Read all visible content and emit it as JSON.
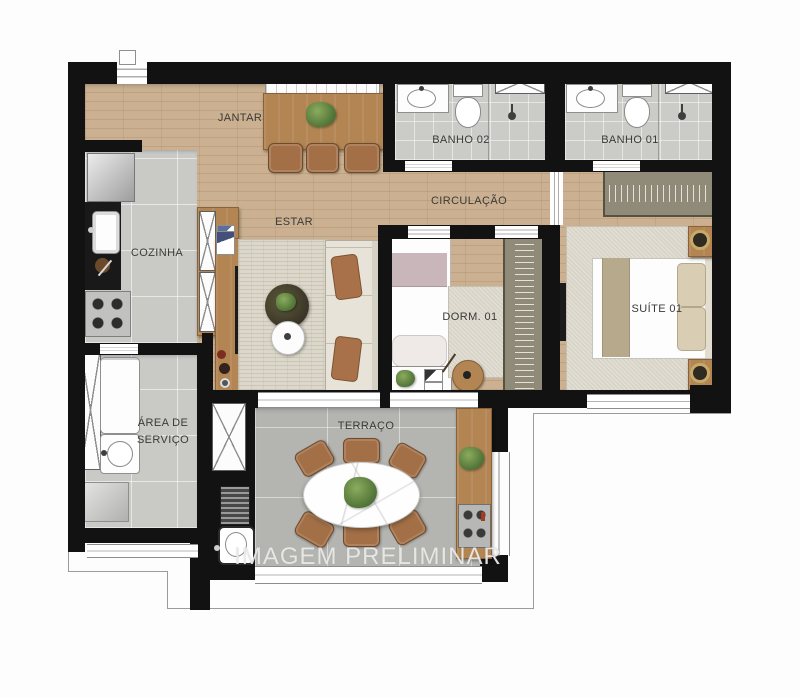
{
  "watermark": {
    "text": "IMAGEM PRELIMINAR"
  },
  "rooms": {
    "jantar": "JANTAR",
    "banho02": "BANHO 02",
    "banho01": "BANHO 01",
    "circulacao": "CIRCULAÇÃO",
    "estar": "ESTAR",
    "cozinha": "COZINHA",
    "dorm01": "DORM. 01",
    "suite01": "SUÍTE 01",
    "area_servico": "ÁREA DE SERVIÇO",
    "terraco": "TERRAÇO"
  },
  "colors": {
    "wall": "#121212",
    "wood_floor": "#cbb191",
    "tile_light": "#c9c9c6",
    "terrace_tile": "#b4b4b1",
    "rug": "#dcd7cb",
    "wood_furniture": "#b28553",
    "chair_brown": "#a26f46",
    "label_text": "#3a3a3a",
    "watermark_text": "#e9e9e9"
  }
}
